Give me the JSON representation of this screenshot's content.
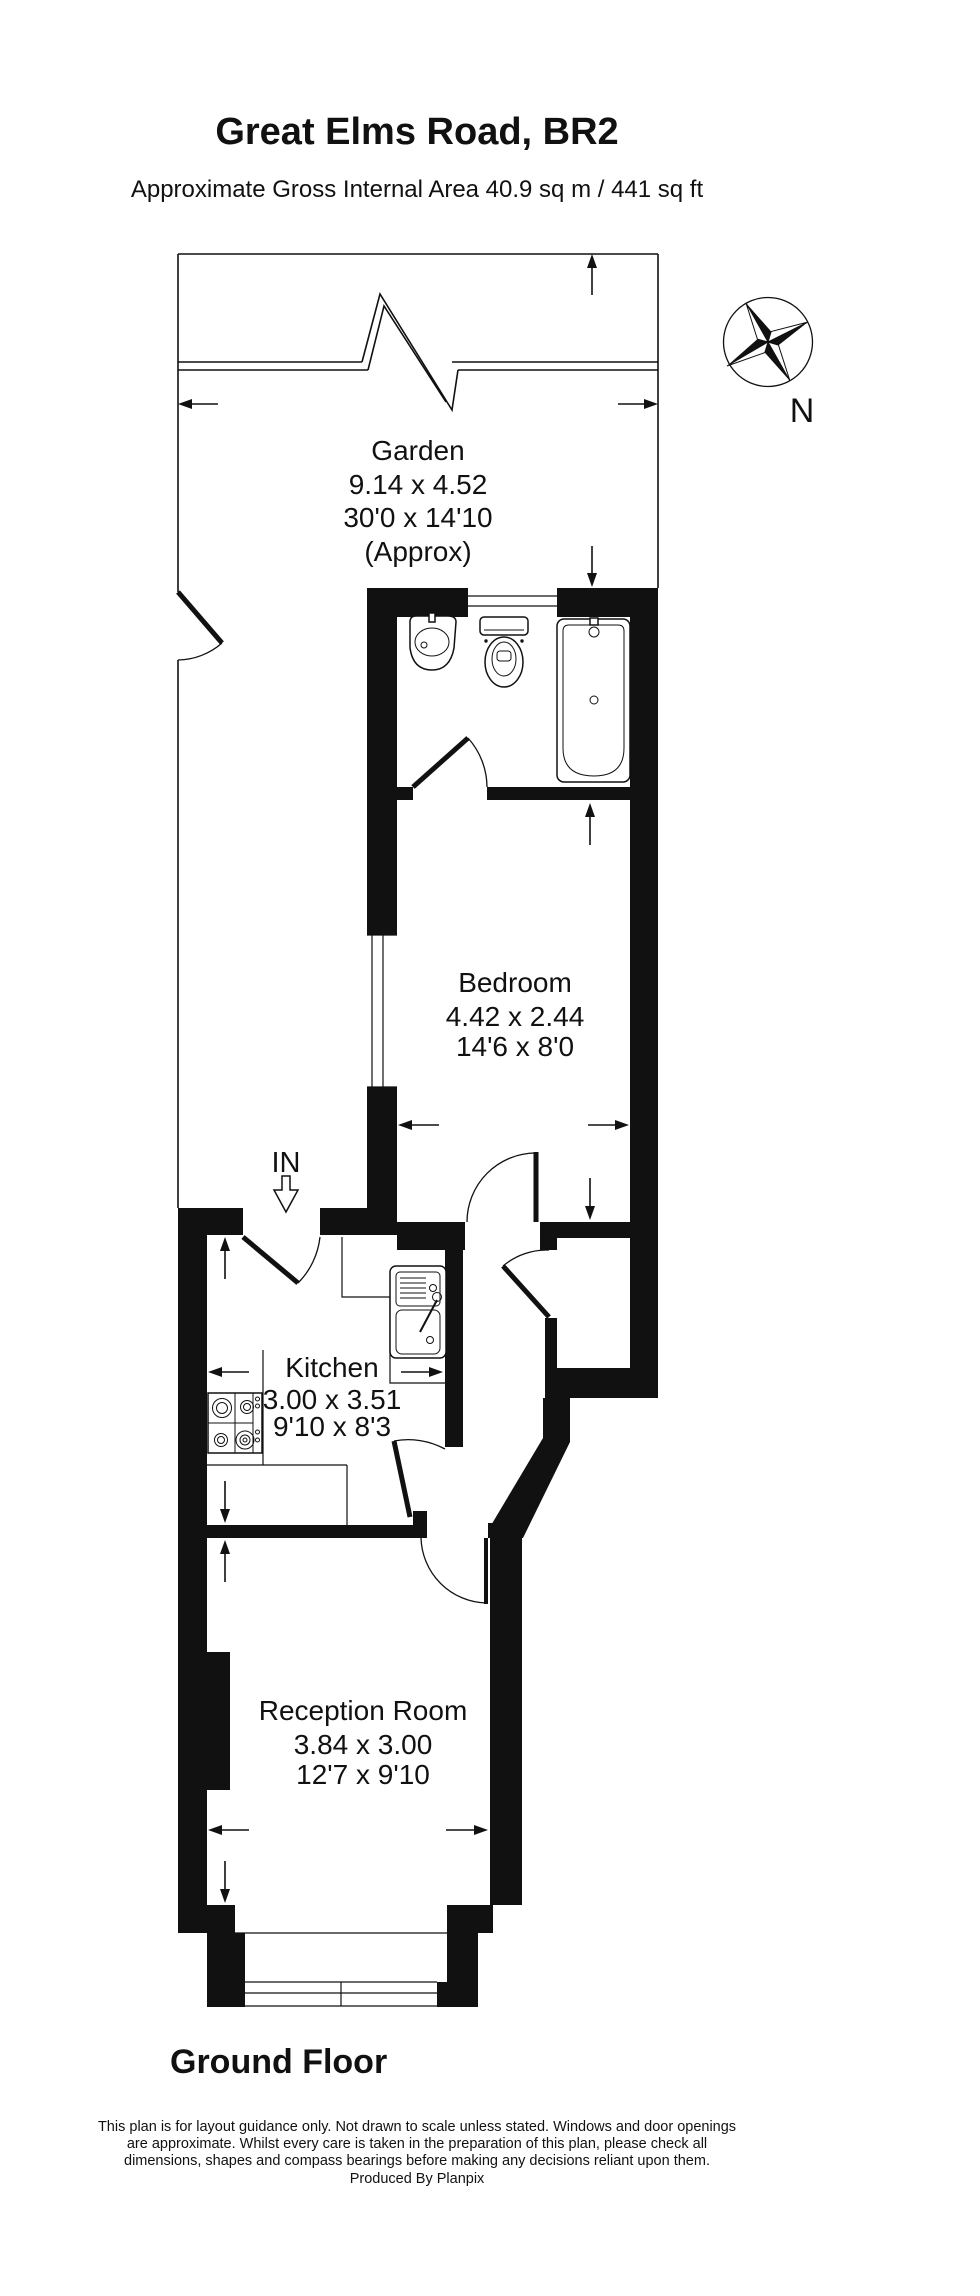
{
  "header": {
    "title": "Great Elms Road, BR2",
    "subtitle": "Approximate Gross Internal Area 40.9 sq m / 441 sq ft"
  },
  "compass": {
    "north_label": "N"
  },
  "entrance": {
    "label": "IN"
  },
  "rooms": {
    "garden": {
      "name": "Garden",
      "metric": "9.14 x 4.52",
      "imperial": "30'0 x 14'10",
      "note": "(Approx)"
    },
    "bedroom": {
      "name": "Bedroom",
      "metric": "4.42 x 2.44",
      "imperial": "14'6 x 8'0"
    },
    "kitchen": {
      "name": "Kitchen",
      "metric": "3.00 x 3.51",
      "imperial": "9'10 x 8'3"
    },
    "reception": {
      "name": "Reception Room",
      "metric": "3.84 x 3.00",
      "imperial": "12'7 x 9'10"
    }
  },
  "floor": {
    "label": "Ground Floor"
  },
  "footer": {
    "line1": "This plan is for layout guidance only. Not drawn to scale unless stated. Windows and door openings",
    "line2": "are approximate. Whilst every care is taken in the preparation of this plan, please check all",
    "line3": "dimensions, shapes and compass bearings before making any decisions reliant upon them.",
    "line4": "Produced By Planpix"
  },
  "colors": {
    "ink": "#111111",
    "paper": "#ffffff"
  }
}
